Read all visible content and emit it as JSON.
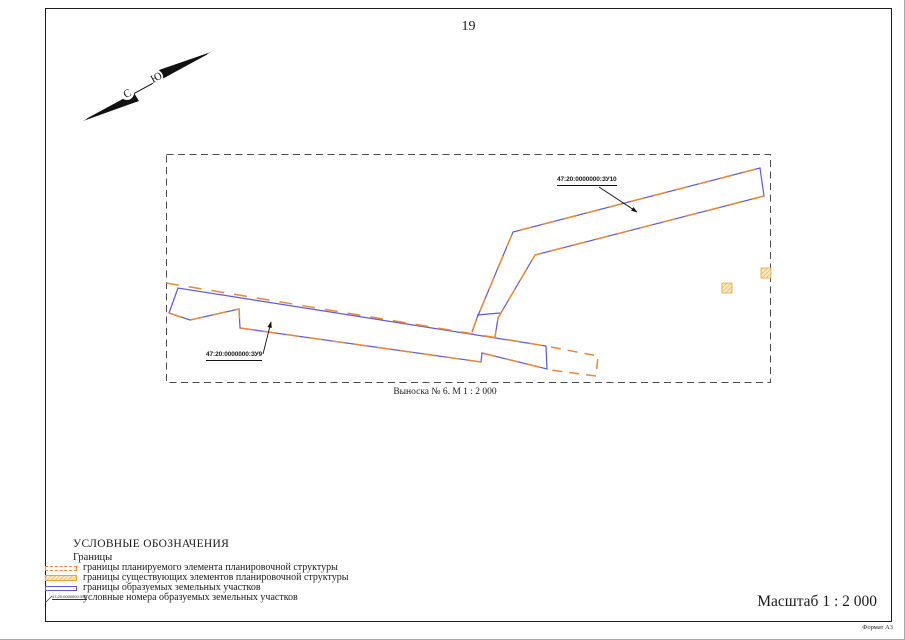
{
  "page": {
    "number": "19",
    "scale_label": "Масштаб 1 : 2 000",
    "format_label": "Формат А3"
  },
  "compass": {
    "letter_sw": "С",
    "letter_ne": "Ю"
  },
  "map": {
    "caption": "Выноска № 6. М 1 : 2 000",
    "parcel_labels": {
      "zu9": "47:20:0000000:ЗУ9",
      "zu10": "47:20:0000000:ЗУ10"
    }
  },
  "legend": {
    "title": "УСЛОВНЫЕ ОБОЗНАЧЕНИЯ",
    "group_label": "Границы",
    "items": [
      {
        "key": "planned",
        "label": "границы планируемого элемента планировочной структуры"
      },
      {
        "key": "existing",
        "label": "границы существующих элементов планировочной структуры"
      },
      {
        "key": "formed",
        "label": "границы образуемых земельных участков"
      },
      {
        "key": "numbers",
        "label": "условные номера образуемых земельных участков"
      }
    ],
    "sample_number": "47:20:0000000:ЗУ1"
  },
  "colors": {
    "planned-boundary": "#ED8733",
    "existing-boundary": "#F5C87E",
    "formed-boundary": "#5A5ADC",
    "frame": "#4a4a4a"
  }
}
